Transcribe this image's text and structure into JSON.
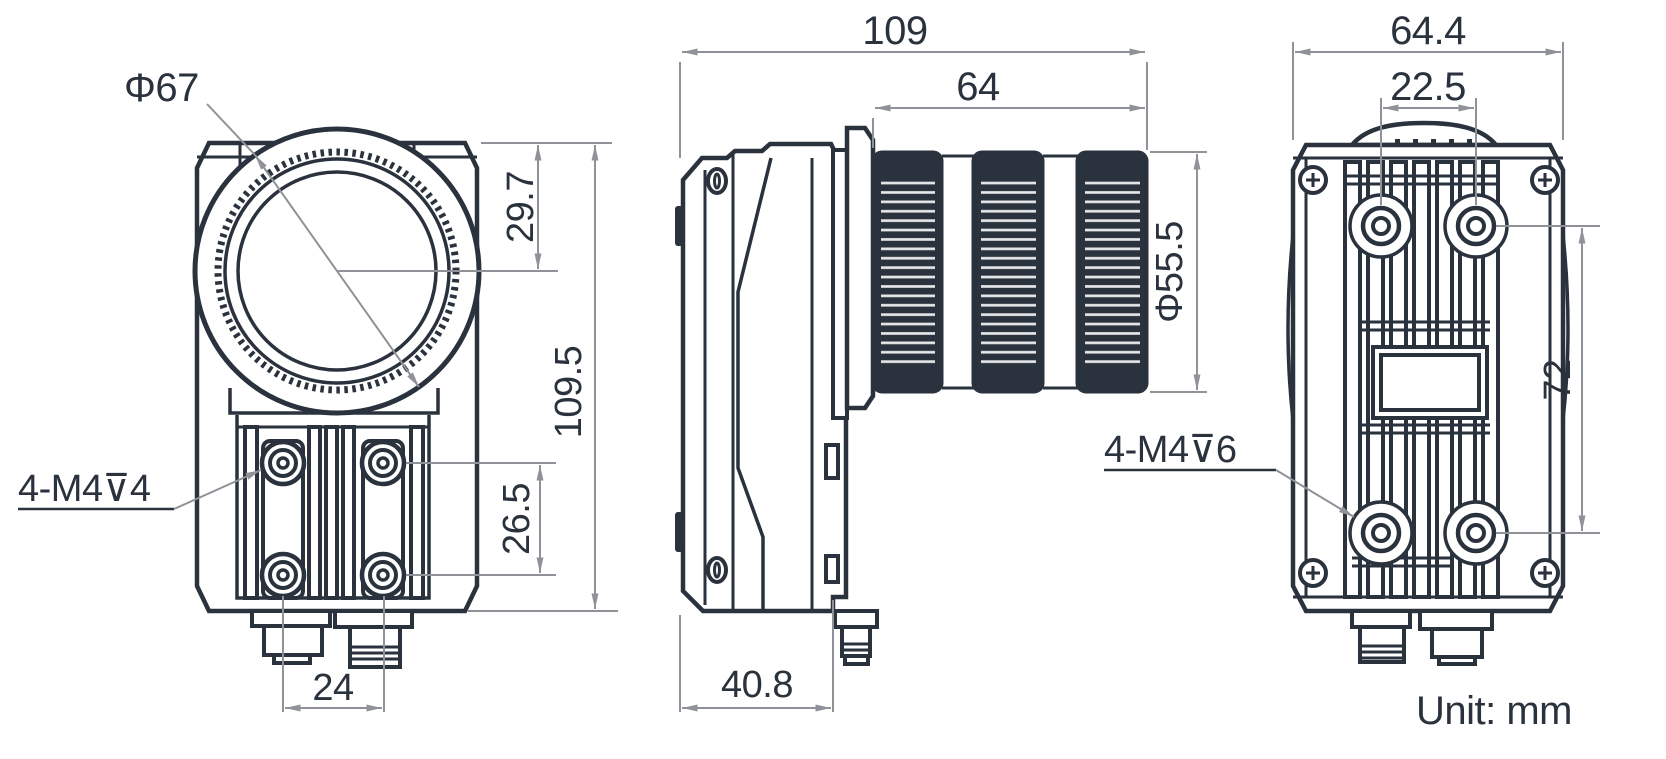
{
  "drawing": {
    "unit_note": "Unit: mm",
    "colors": {
      "line": "#2a323d",
      "dimension": "#8f9298",
      "background": "#ffffff"
    },
    "front": {
      "lens_diameter_label": "Φ67",
      "thread_note": "4-M4⊽4",
      "dim_lens_center_from_top": "29.7",
      "dim_overall_height": "109.5",
      "dim_hole_spacing_vertical": "26.5",
      "dim_hole_spacing_horizontal": "24"
    },
    "side": {
      "dim_overall_length": "109",
      "dim_lens_length": "64",
      "dim_lens_diameter": "Φ55.5",
      "dim_body_depth": "40.8"
    },
    "back": {
      "thread_note": "4-M4⊽6",
      "dim_overall_width": "64.4",
      "dim_hole_spacing_horizontal": "22.5",
      "dim_hole_spacing_vertical": "72"
    }
  }
}
